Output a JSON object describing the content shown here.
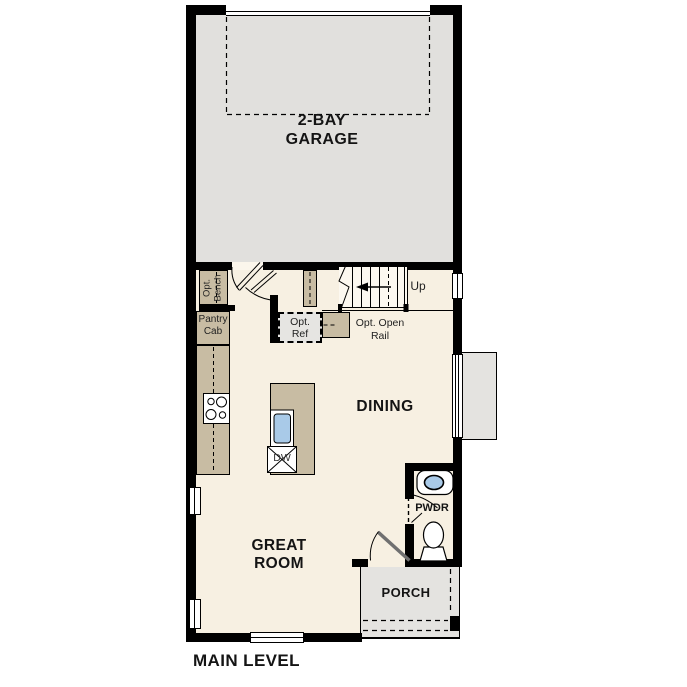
{
  "plan": {
    "title": "MAIN LEVEL",
    "garage": {
      "line1": "2-BAY",
      "line2": "GARAGE"
    },
    "dining": "DINING",
    "great_room": {
      "line1": "GREAT",
      "line2": "ROOM"
    },
    "porch": "PORCH",
    "powder": "PWDR",
    "stairs_up": "Up",
    "opt_bench": {
      "line1": "Opt.",
      "line2": "Bench"
    },
    "pantry_cab": {
      "line1": "Pantry",
      "line2": "Cab"
    },
    "opt_ref": {
      "line1": "Opt.",
      "line2": "Ref"
    },
    "opt_open_rail": {
      "line1": "Opt. Open",
      "line2": "Rail"
    },
    "dishwasher": "DW",
    "colors": {
      "wall": "#000000",
      "floor": "#f7f0e2",
      "garage_floor": "#e1e0dd",
      "casework": "#c8bca3",
      "porch": "#e4e3e0",
      "fixture_blue": "#a9cae8"
    }
  }
}
